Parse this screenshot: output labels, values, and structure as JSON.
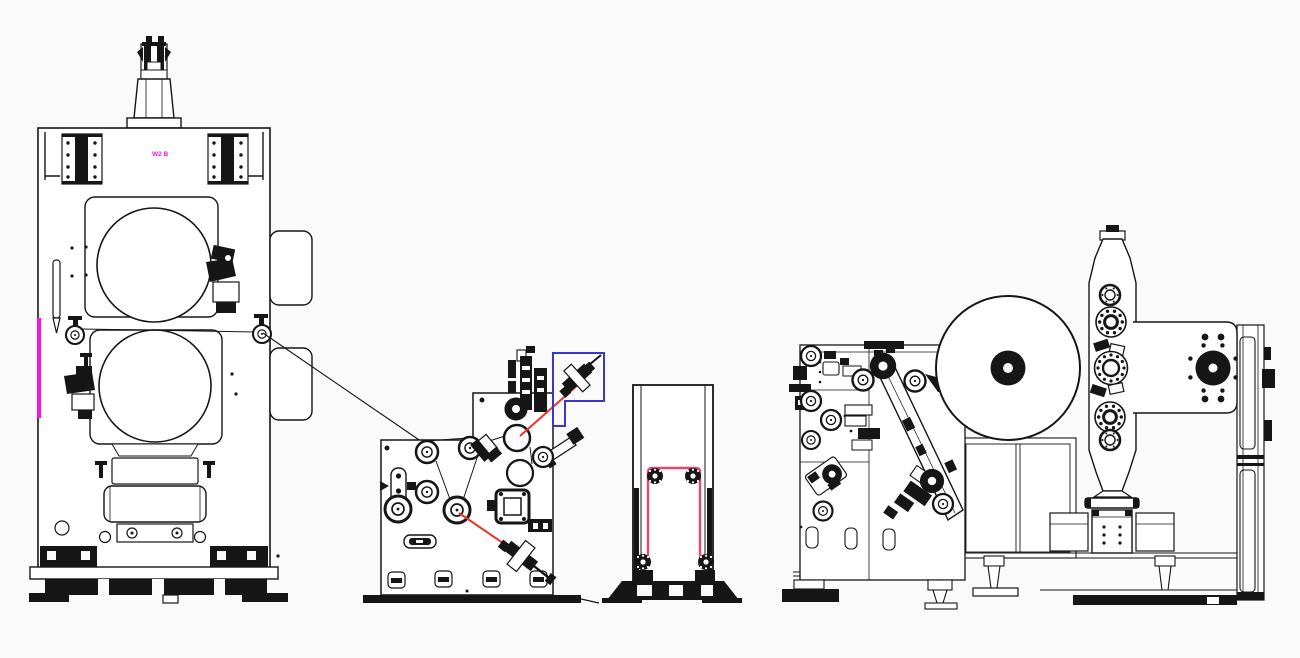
{
  "drawing": {
    "label": "W2 B"
  },
  "colors": {
    "bg": "#fafafa",
    "ink": "#161616",
    "red": "#f03226",
    "pink": "#e9486b",
    "blue": "#3936cc",
    "magenta": "#ff10e0"
  }
}
